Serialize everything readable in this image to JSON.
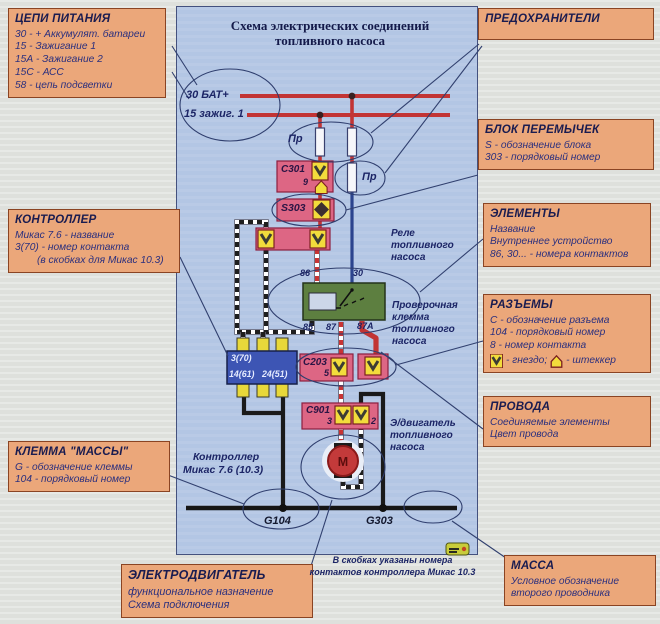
{
  "palette": {
    "page_bg": "#e2e4e0",
    "panel_bg": "#b3c6e4",
    "callout_bg": "#eba77a",
    "callout_border": "#8a4423",
    "pink_box": "#dd6684",
    "yellow_contact": "#f2dc3c",
    "relay_green": "#5d7f40",
    "controller_blue": "#3d55b4",
    "wire_red": "#c23434",
    "wire_blue": "#2c448e",
    "wire_black": "#1a1a1a",
    "text_navy": "#1c2566"
  },
  "title_box": {
    "line1": "Схема электрических соединений",
    "line2": "топливного насоса"
  },
  "callouts": {
    "power": {
      "title": "ЦЕПИ ПИТАНИЯ",
      "lines": [
        "30 - + Аккумулят. батареи",
        "15 - Зажигание 1",
        "15А - Зажигание 2",
        "15С - АСС",
        "58 - цепь подсветки"
      ]
    },
    "fuses": {
      "title": "ПРЕДОХРАНИТЕЛИ"
    },
    "jumper": {
      "title": "БЛОК ПЕРЕМЫЧЕК",
      "lines": [
        "S - обозначение блока",
        "303 - порядковый номер"
      ]
    },
    "elements": {
      "title": "ЭЛЕМЕНТЫ",
      "lines": [
        "Название",
        "Внутреннее устройство",
        "86, 30... - номера контактов"
      ]
    },
    "connectors": {
      "title": "РАЗЪЕМЫ",
      "lines": [
        "С - обозначение разъема",
        "104 - порядковый номер",
        "8 - номер контакта"
      ],
      "socket_label": "- гнездо;",
      "plug_label": "- штеккер"
    },
    "wires": {
      "title": "ПРОВОДА",
      "lines": [
        "Соединяемые элементы",
        "Цвет провода"
      ]
    },
    "mass": {
      "title": "МАССА",
      "lines": [
        "Условное обозначение",
        "второго проводника"
      ]
    },
    "controller": {
      "title": "КОНТРОЛЛЕР",
      "lines": [
        "Микас 7.6 - название",
        "3(70) - номер контакта",
        "(в скобках для Микас 10.3)"
      ]
    },
    "clamp": {
      "title": "КЛЕММА \"МАССЫ\"",
      "lines": [
        "G - обозначение клеммы",
        "104 - порядковый номер"
      ]
    },
    "motor": {
      "title": "ЭЛЕКТРОДВИГАТЕЛЬ",
      "lines": [
        "функциональное назначение",
        "Схема подключения"
      ]
    }
  },
  "footnote": {
    "line1": "В скобках указаны номера",
    "line2": "контактов контроллера Микас 10.3"
  },
  "diagram": {
    "bus30": "30 БАТ+",
    "bus15": "15 зажиг. 1",
    "fuse1": "Пр",
    "fuse2": "Пр",
    "c301": "С301",
    "c301_pin": "9",
    "s303": "S303",
    "relay_label": {
      "l1": "Реле",
      "l2": "топливного",
      "l3": "насоса"
    },
    "relay_pins": {
      "p86": "86",
      "p30": "30",
      "p85": "85",
      "p87": "87",
      "p87a": "87А"
    },
    "check_label": {
      "l1": "Проверочная",
      "l2": "клемма",
      "l3": "топливного",
      "l4": "насоса"
    },
    "c203": "С203",
    "c203_pin": "5",
    "c901": "С901",
    "c901_pin3": "3",
    "c901_pin2": "2",
    "motor_letter": "М",
    "motor_label": {
      "l1": "Э/двигатель",
      "l2": "топливного",
      "l3": "насоса"
    },
    "ctrl_pin_top": "3(70)",
    "ctrl_pin_b1": "14(61)",
    "ctrl_pin_b2": "24(51)",
    "ctrl_label": {
      "l1": "Контроллер",
      "l2": "Микас 7.6 (10.3)"
    },
    "g104": "G104",
    "g303": "G303"
  },
  "icons": {
    "socket": "socket-contact-icon",
    "plug": "plug-contact-icon",
    "badge": "publisher-badge"
  }
}
